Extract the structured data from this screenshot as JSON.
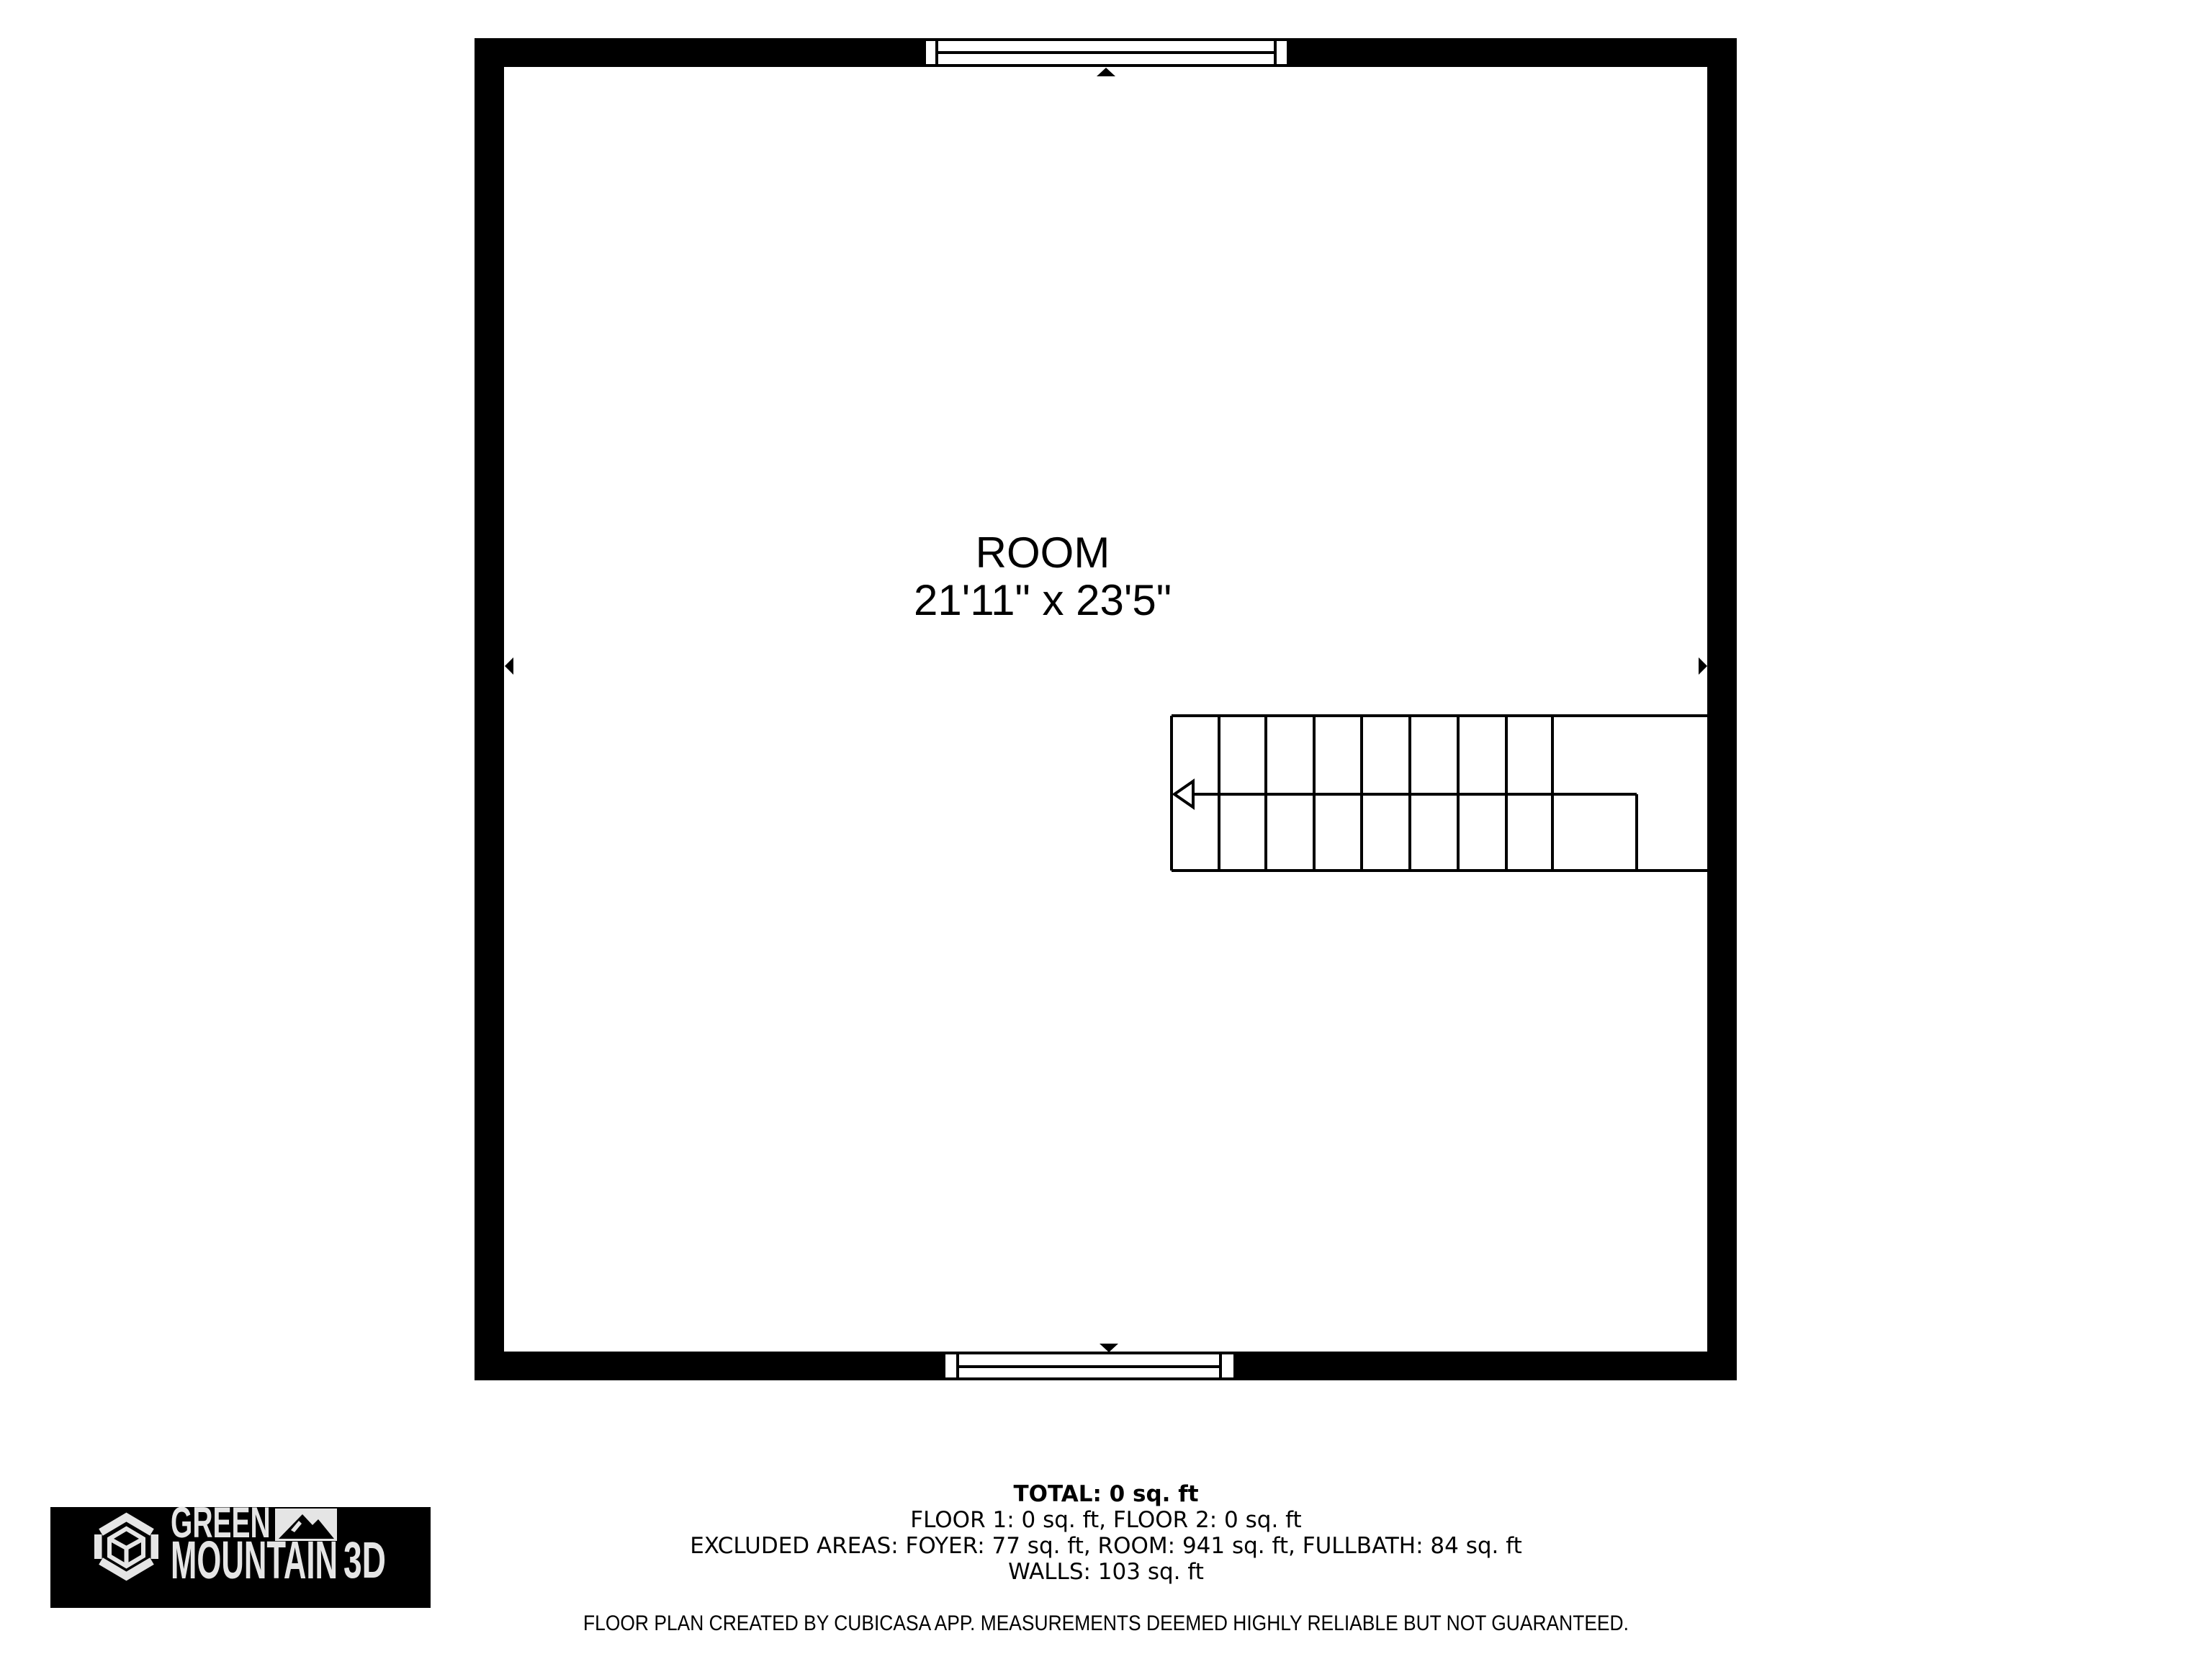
{
  "floor_plan": {
    "room_label": "ROOM",
    "room_dimensions": "21'11\" x 23'5\"",
    "wall_color": "#000000",
    "background": "#ffffff"
  },
  "summary": {
    "total_line": "TOTAL: 0 sq. ft",
    "floors_line": "FLOOR 1: 0 sq. ft, FLOOR 2: 0 sq. ft",
    "excluded_line": "EXCLUDED AREAS: FOYER: 77 sq. ft, ROOM: 941 sq. ft, FULLBATH: 84 sq. ft",
    "walls_line": "WALLS: 103 sq. ft",
    "values": {
      "total_sqft": 0,
      "floor1_sqft": 0,
      "floor2_sqft": 0,
      "foyer_sqft": 77,
      "room_sqft": 941,
      "fullbath_sqft": 84,
      "walls_sqft": 103
    }
  },
  "disclaimer": "FLOOR PLAN CREATED BY CUBICASA APP. MEASUREMENTS DEEMED HIGHLY RELIABLE BUT NOT GUARANTEED.",
  "logo": {
    "word_top": "GREEN",
    "word_bottom": "MOUNTAIN",
    "suffix": "3D",
    "bg_color": "#000000",
    "fg_color": "#e5e5e5"
  }
}
